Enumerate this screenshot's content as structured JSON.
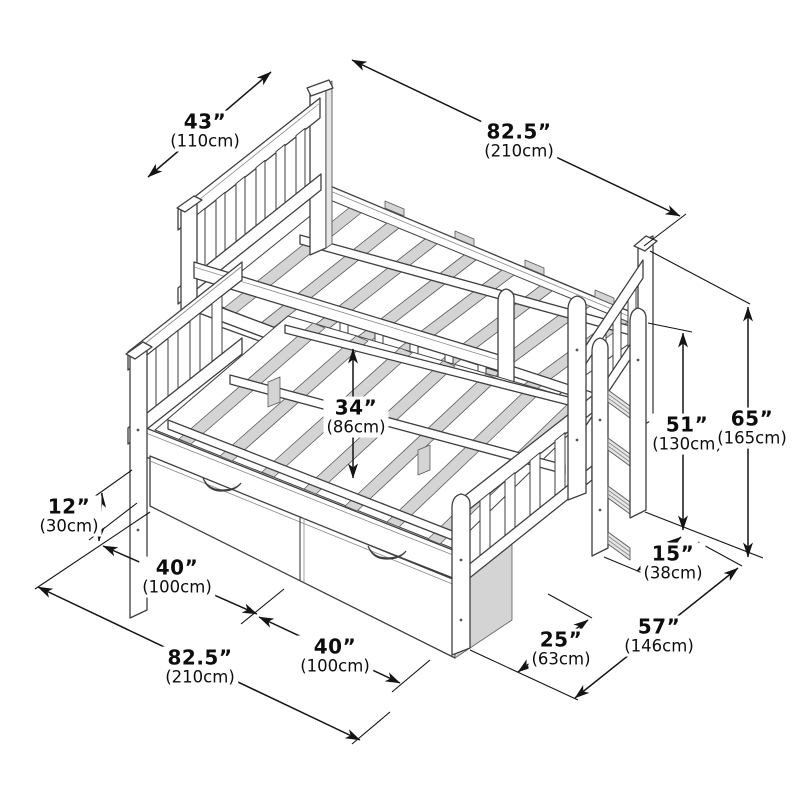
{
  "figure": {
    "kind": "product dimension diagram",
    "subject": "twin-over-full bunk bed with ladder and two storage drawers",
    "background_color": "#ffffff",
    "line_color": "#3f3f3f",
    "dimension_color": "#141414",
    "shading_color": "#d4d4d4"
  },
  "dimensions": [
    {
      "id": "upper-bunk-width",
      "inches": "43”",
      "cm": "(110cm)"
    },
    {
      "id": "upper-bunk-length",
      "inches": "82.5”",
      "cm": "(210cm)"
    },
    {
      "id": "bunk-clearance",
      "inches": "34”",
      "cm": "(86cm)"
    },
    {
      "id": "ladder-height",
      "inches": "51”",
      "cm": "(130cm)"
    },
    {
      "id": "overall-height",
      "inches": "65”",
      "cm": "(165cm)"
    },
    {
      "id": "ladder-depth",
      "inches": "15”",
      "cm": "(38cm)"
    },
    {
      "id": "drawer-height",
      "inches": "12”",
      "cm": "(30cm)"
    },
    {
      "id": "drawer-width-left",
      "inches": "40”",
      "cm": "(100cm)"
    },
    {
      "id": "drawer-width-right",
      "inches": "40”",
      "cm": "(100cm)"
    },
    {
      "id": "overall-length",
      "inches": "82.5”",
      "cm": "(210cm)"
    },
    {
      "id": "ladder-footprint",
      "inches": "25”",
      "cm": "(63cm)"
    },
    {
      "id": "overall-width",
      "inches": "57”",
      "cm": "(146cm)"
    }
  ]
}
